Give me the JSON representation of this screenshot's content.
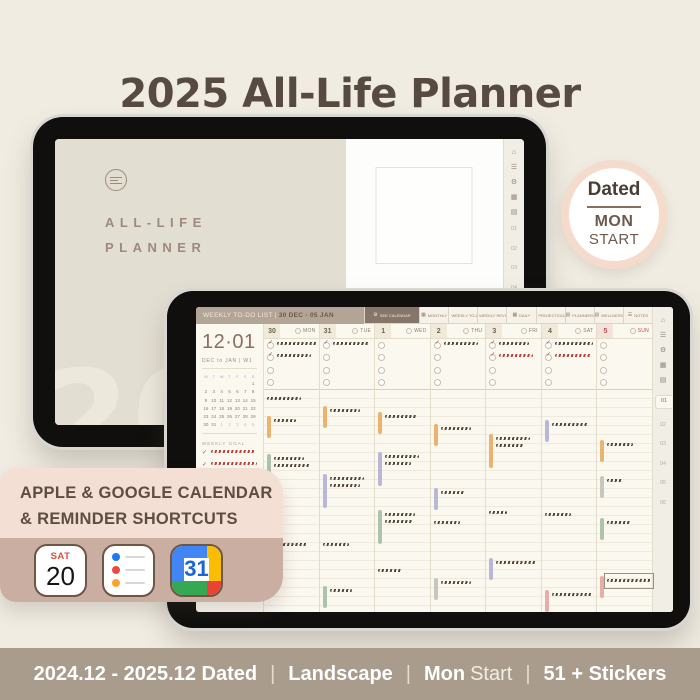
{
  "title": "2025 All-Life Planner",
  "dated_badge": {
    "top": "Dated",
    "mid": "MON",
    "bottom": "START"
  },
  "cover_tablet": {
    "logo_line1": "ALL-LIFE",
    "logo_line2": "PLANNER",
    "watermark": "2025",
    "strip_icons": [
      "home",
      "list",
      "settings",
      "calendar",
      "calendar-alt"
    ],
    "strip_tabs": [
      "01",
      "02",
      "03",
      "04",
      "05",
      "06"
    ],
    "active_tab": -1
  },
  "planner_tablet": {
    "header_title": "WEEKLY TO-DO LIST | ",
    "header_range": "30 DEC - 05 JAN",
    "tabs": [
      {
        "label": "SEE CALENDAR",
        "icon": "settings",
        "active": true
      },
      {
        "label": "MONTHLY",
        "icon": "calendar"
      },
      {
        "label": "WEEKLY TO-DO",
        "icon": "calendar"
      },
      {
        "label": "WEEKLY REVIEW",
        "icon": "calendar"
      },
      {
        "label": "DAILY",
        "icon": "calendar"
      },
      {
        "label": "PROJECT/GOAL",
        "icon": "list"
      },
      {
        "label": "PLANNERS",
        "icon": "calendar-alt"
      },
      {
        "label": "WELLNESS",
        "icon": "calendar-alt"
      },
      {
        "label": "NOTES",
        "icon": "list"
      }
    ],
    "sidebar": {
      "big_date": "12·01",
      "range_label": "DEC to JAN | W1",
      "mini_calendar_head": [
        "M",
        "T",
        "W",
        "T",
        "F",
        "S",
        "S"
      ],
      "mini_calendar_weeks": [
        [
          "",
          "",
          "",
          "",
          "",
          "",
          "1"
        ],
        [
          "2",
          "3",
          "4",
          "5",
          "6",
          "7",
          "8"
        ],
        [
          "9",
          "10",
          "11",
          "12",
          "13",
          "14",
          "15"
        ],
        [
          "16",
          "17",
          "18",
          "19",
          "20",
          "21",
          "22"
        ],
        [
          "23",
          "24",
          "25",
          "26",
          "27",
          "28",
          "29"
        ],
        [
          "30",
          "31",
          {
            "v": "1",
            "dim": true
          },
          {
            "v": "2",
            "dim": true
          },
          {
            "v": "3",
            "dim": true
          },
          {
            "v": "4",
            "dim": true
          },
          {
            "v": "5",
            "dim": true
          }
        ]
      ],
      "weekly_goal_label": "WEEKLY GOAL",
      "goals": [
        {
          "check": true,
          "ink": "red",
          "w": 44
        },
        {
          "check": true,
          "ink": "red",
          "w": 46
        },
        {
          "check": false,
          "ink": "dark",
          "w": 42,
          "w2": 38
        }
      ]
    },
    "days": [
      {
        "date": "30",
        "weekday": "MON",
        "todos": [
          {
            "check": true,
            "ink": "dark",
            "w": 40
          },
          {
            "check": true,
            "ink": "dark",
            "w": 34
          },
          null,
          null
        ],
        "events": [
          {
            "t": 4,
            "bar": "none",
            "ink": "dark",
            "lines": [
              34
            ]
          },
          {
            "t": 26,
            "bar": "orange",
            "ink": "dark",
            "lines": [
              22
            ]
          },
          {
            "t": 64,
            "bar": "green",
            "ink": "dark",
            "lines": [
              30,
              36
            ]
          },
          {
            "t": 150,
            "bar": "none",
            "ink": "dark",
            "lines": [
              40
            ]
          }
        ]
      },
      {
        "date": "31",
        "weekday": "TUE",
        "todos": [
          {
            "check": true,
            "ink": "dark",
            "w": 36
          },
          null,
          null,
          null
        ],
        "events": [
          {
            "t": 16,
            "bar": "orange",
            "ink": "dark",
            "lines": [
              30
            ]
          },
          {
            "t": 84,
            "bar": "lavender",
            "ink": "dark",
            "lines": [
              34,
              30
            ]
          },
          {
            "t": 150,
            "bar": "none",
            "ink": "dark",
            "lines": [
              26
            ]
          },
          {
            "t": 196,
            "bar": "green",
            "ink": "dark",
            "lines": [
              22
            ]
          }
        ]
      },
      {
        "date": "1",
        "weekday": "WED",
        "todos": [
          null,
          null,
          null,
          null
        ],
        "events": [
          {
            "t": 22,
            "bar": "orange",
            "ink": "dark",
            "lines": [
              32
            ]
          },
          {
            "t": 62,
            "bar": "lavender",
            "ink": "dark",
            "lines": [
              34,
              26
            ]
          },
          {
            "t": 120,
            "bar": "green",
            "ink": "dark",
            "lines": [
              30,
              28
            ]
          },
          {
            "t": 176,
            "bar": "none",
            "ink": "dark",
            "lines": [
              24
            ]
          }
        ]
      },
      {
        "date": "2",
        "weekday": "THU",
        "todos": [
          {
            "check": true,
            "ink": "dark",
            "w": 34
          },
          null,
          null,
          null
        ],
        "events": [
          {
            "t": 34,
            "bar": "orange",
            "ink": "dark",
            "lines": [
              30
            ]
          },
          {
            "t": 98,
            "bar": "lavender",
            "ink": "dark",
            "lines": [
              24
            ]
          },
          {
            "t": 128,
            "bar": "none",
            "ink": "dark",
            "lines": [
              26
            ]
          },
          {
            "t": 188,
            "bar": "gray",
            "ink": "dark",
            "lines": [
              30
            ]
          }
        ]
      },
      {
        "date": "3",
        "weekday": "FRI",
        "todos": [
          {
            "check": true,
            "ink": "dark",
            "w": 30
          },
          {
            "check": true,
            "ink": "red",
            "w": 34
          },
          null,
          null
        ],
        "events": [
          {
            "t": 44,
            "bar": "orange",
            "ink": "dark",
            "lines": [
              34,
              28
            ]
          },
          {
            "t": 118,
            "bar": "none",
            "ink": "dark",
            "lines": [
              18
            ]
          },
          {
            "t": 168,
            "bar": "lavender",
            "ink": "dark",
            "lines": [
              40
            ]
          }
        ]
      },
      {
        "date": "4",
        "weekday": "SAT",
        "todos": [
          {
            "check": true,
            "ink": "dark",
            "w": 38
          },
          {
            "check": true,
            "ink": "red",
            "w": 36
          },
          null,
          null
        ],
        "events": [
          {
            "t": 30,
            "bar": "lavender",
            "ink": "dark",
            "lines": [
              36
            ]
          },
          {
            "t": 120,
            "bar": "none",
            "ink": "dark",
            "lines": [
              26
            ]
          },
          {
            "t": 200,
            "bar": "pink",
            "ink": "dark",
            "lines": [
              40
            ]
          }
        ]
      },
      {
        "date": "5",
        "weekday": "SUN",
        "sun": true,
        "todos": [
          null,
          null,
          null,
          null
        ],
        "events": [
          {
            "t": 50,
            "bar": "orange",
            "ink": "dark",
            "lines": [
              26
            ]
          },
          {
            "t": 86,
            "bar": "gray",
            "ink": "dark",
            "lines": [
              16
            ]
          },
          {
            "t": 128,
            "bar": "green",
            "ink": "dark",
            "lines": [
              24
            ]
          },
          {
            "t": 186,
            "bar": "pink",
            "ink": "dark",
            "lines": [
              44
            ],
            "boxed": true
          }
        ]
      }
    ],
    "strip_icons": [
      "home",
      "list",
      "settings",
      "calendar",
      "calendar-alt"
    ],
    "strip_tabs": [
      "01",
      "02",
      "03",
      "04",
      "05",
      "06"
    ],
    "active_tab": 0
  },
  "shortcut_card": {
    "line1": "APPLE & GOOGLE CALENDAR",
    "line2": "& REMINDER SHORTCUTS",
    "apple_calendar": {
      "weekday": "SAT",
      "day": "20"
    },
    "reminder_colors": [
      "#1E79F2",
      "#EA4A41",
      "#F7A52B"
    ],
    "google_calendar": {
      "day": "31",
      "colors": {
        "blue": "#4285F4",
        "yellow": "#FBBC04",
        "green": "#34A853",
        "red": "#EA4335",
        "number": "#1967D2"
      }
    }
  },
  "footer": {
    "segment1": "2024.12 - 2025.12 Dated",
    "segment2": "Landscape",
    "segment3_bold": "Mon",
    "segment3_light": "Start",
    "segment4": "51 + Stickers",
    "separator": "|"
  }
}
